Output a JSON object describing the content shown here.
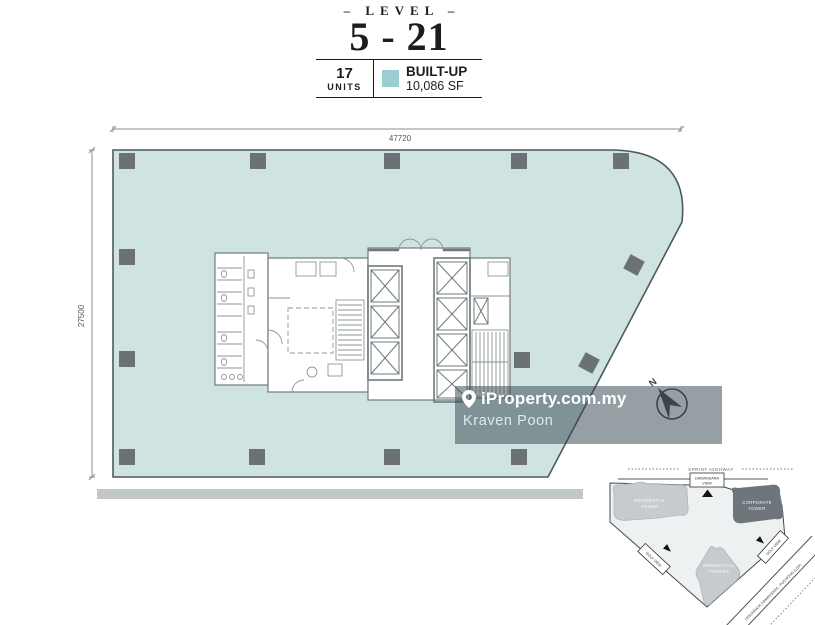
{
  "header": {
    "level_label": "– LEVEL –",
    "level_range": "5 - 21",
    "units_value": "17",
    "units_label": "UNITS",
    "builtup_label": "BUILT-UP",
    "builtup_value": "10,086 SF"
  },
  "dimensions": {
    "width": "47720",
    "height": "27500"
  },
  "watermark": {
    "brand": "iProperty.com.my",
    "agent": "Kraven Poon"
  },
  "compass": {
    "north_label": "N"
  },
  "colors": {
    "plan_fill": "#cfe3e1",
    "plan_outline": "#4d585e",
    "column_fill": "#6b7174",
    "legend_swatch": "#9ccdd2",
    "watermark_fill": "#36474f"
  },
  "sitemap": {
    "highway": "SPRINT HIGHWAY",
    "junction_box": {
      "line1": "DAMANSARA",
      "line2": "VIEW"
    },
    "tower_residential_main": {
      "line1": "RESIDENTIAL",
      "line2": "TOWER"
    },
    "tower_corporate": {
      "line1": "CORPORATE",
      "line2": "TOWER"
    },
    "tower_residential_south": {
      "line1": "RESIDENTIAL",
      "line2": "TOWERS"
    },
    "golf_view_left": "GOLF VIEW",
    "golf_view_right": "GOLF VIEW",
    "road": "LEBUHRAYA DAMANSARA - PUCHONG (LDP)"
  }
}
